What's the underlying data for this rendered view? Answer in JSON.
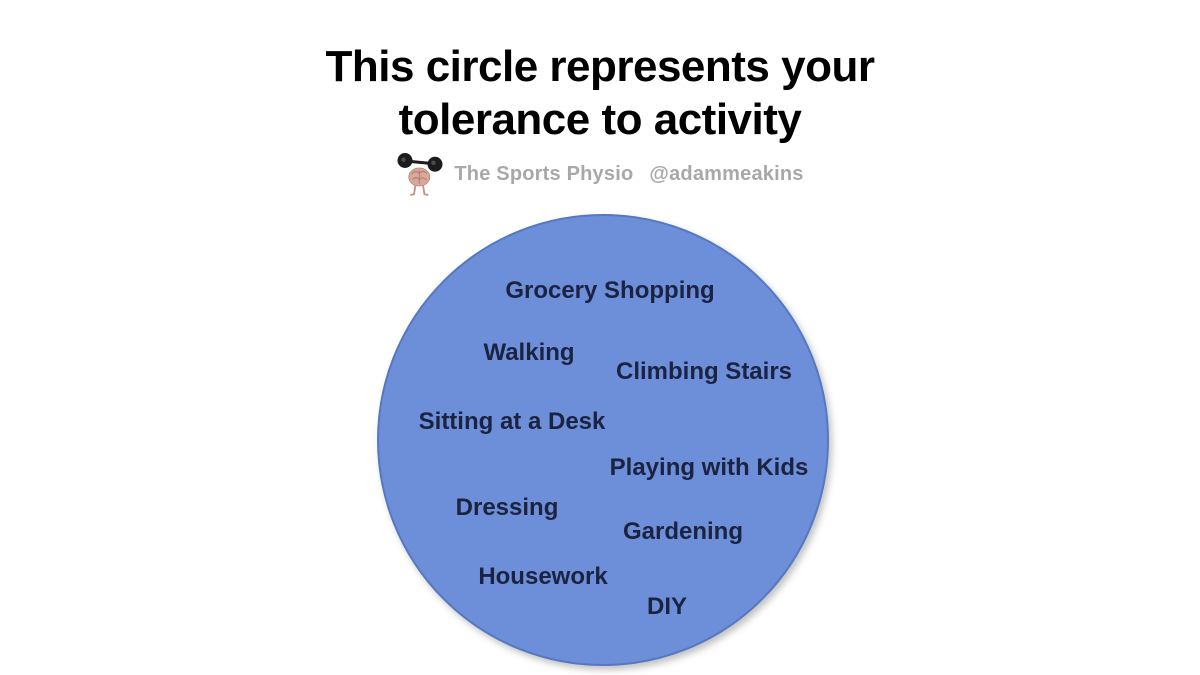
{
  "slide": {
    "background_color": "#ffffff"
  },
  "title": {
    "line1": "This circle represents your",
    "line2": "tolerance to activity",
    "color": "#000000"
  },
  "attribution": {
    "brand": "The Sports Physio",
    "handle": "@adammeakins",
    "text_color": "#a8a8a8",
    "logo_icon": "brain-lifting-barbell-icon"
  },
  "circle": {
    "fill_color": "#6d8fd9",
    "border_color": "#5478c1",
    "label_color": "#1b2340",
    "activities": [
      {
        "label": "Grocery Shopping",
        "x": 231,
        "y": 75
      },
      {
        "label": "Walking",
        "x": 150,
        "y": 137
      },
      {
        "label": "Climbing Stairs",
        "x": 325,
        "y": 156
      },
      {
        "label": "Sitting at a Desk",
        "x": 133,
        "y": 206
      },
      {
        "label": "Playing with Kids",
        "x": 330,
        "y": 252
      },
      {
        "label": "Dressing",
        "x": 128,
        "y": 292
      },
      {
        "label": "Gardening",
        "x": 304,
        "y": 316
      },
      {
        "label": "Housework",
        "x": 164,
        "y": 361
      },
      {
        "label": "DIY",
        "x": 288,
        "y": 391
      }
    ]
  }
}
